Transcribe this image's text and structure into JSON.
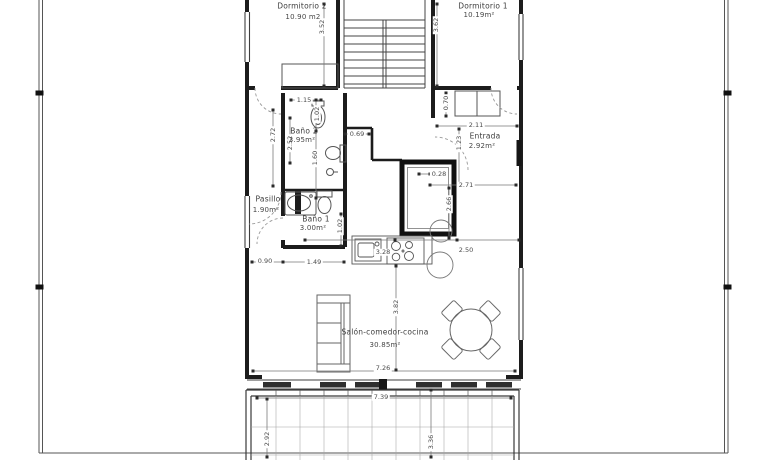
{
  "colors": {
    "background": "#ffffff",
    "wall": "#1c1c1c",
    "thin_line": "#555555",
    "dashed_door": "#999999",
    "grid": "#a3a3a3",
    "text": "#3d3d3d"
  },
  "rooms": {
    "dormitorio2": {
      "name": "Dormitorio 2",
      "area": "10.90 m2"
    },
    "dormitorio1": {
      "name": "Dormitorio 1",
      "area": "10.19m²"
    },
    "bano2": {
      "name": "Baño 2",
      "area": "3.95m²"
    },
    "bano1": {
      "name": "Baño 1",
      "area": "3.00m²"
    },
    "pasillo": {
      "name": "Pasillo",
      "area": "1.90m²"
    },
    "entrada": {
      "name": "Entrada",
      "area": "2.92m²"
    },
    "salon": {
      "name": "Salón-comedor-cocina",
      "area": "30.85m²"
    }
  },
  "dimensions": {
    "dorm2_depth": "3.52",
    "dorm1_depth": "3.62",
    "closet_depth": "0.70",
    "entrada_width": "2.11",
    "entrada_depth": "1.23",
    "bano2_width": "1.15",
    "bano2_fixture_length": "1.02",
    "bano2_offset": "0.69",
    "bano2_depth": "2.72",
    "bano2_left_depth": "2.52",
    "bano2_inner_length": "1.60",
    "wall_offset": "0.28",
    "hall_width": "2.71",
    "hall_depth": "2.66",
    "pasillo_width": "0.90",
    "bano1_width": "1.49",
    "bano1_depth": "1.02",
    "kitchen_run": "3.28",
    "kitchen_to_wall": "2.50",
    "salon_depth": "3.82",
    "salon_width": "7.26",
    "terrace_width": "7.39",
    "terrace_depth_left": "2.92",
    "terrace_depth_mid": "3.36"
  }
}
